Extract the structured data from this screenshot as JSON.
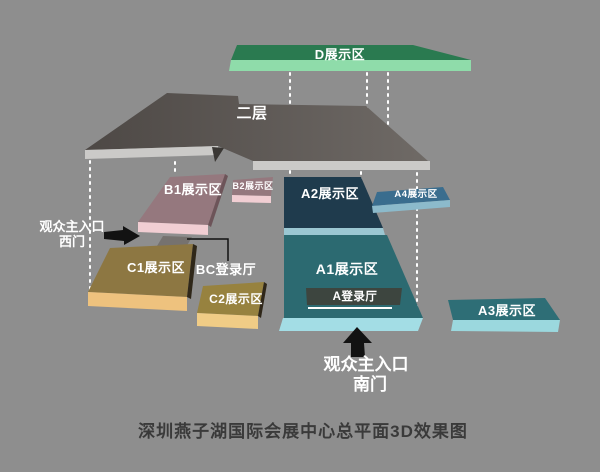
{
  "caption": "深圳燕子湖国际会展中心总平面3D效果图",
  "zones": {
    "d": {
      "label": "D展示区"
    },
    "floor2": {
      "label": "二层"
    },
    "b1": {
      "label": "B1展示区"
    },
    "b2": {
      "label": "B2展示区"
    },
    "c1": {
      "label": "C1展示区"
    },
    "c2": {
      "label": "C2展示区"
    },
    "a1": {
      "label": "A1展示区"
    },
    "a2": {
      "label": "A2展示区"
    },
    "a3": {
      "label": "A3展示区"
    },
    "a4": {
      "label": "A4展示区"
    },
    "a_hall": {
      "label": "A登录厅"
    },
    "bc_hall": {
      "label": "BC登录厅"
    }
  },
  "entrances": {
    "west": {
      "line1": "观众主入口",
      "line2": "西门"
    },
    "south": {
      "line1": "观众主入口",
      "line2": "南门"
    }
  },
  "colors": {
    "background": "#8e8e8e",
    "d_top": "#2a7a50",
    "d_front": "#8fdcaa",
    "floor2_top_dark": "#4d4845",
    "floor2_top_light": "#6f6a66",
    "floor2_front": "#cbcac8",
    "floor2_wedge": "#3a3734",
    "b_top": "#95787e",
    "b_side": "#6d5459",
    "b_front": "#f1ced3",
    "ramp": "#76726f",
    "c1_top": "#8d7742",
    "c2_top": "#97823f",
    "c_side": "#2f2719",
    "c1_front": "#eec27e",
    "c2_front": "#f0cc86",
    "a1_top": "#2c6a71",
    "a1_front": "#a3dde5",
    "a2_top": "#1f3b4d",
    "a2_front": "#9bc7d2",
    "a3_top": "#2e6e76",
    "a3_front": "#9bd8de",
    "a4_top": "#3a6d8e",
    "a4_front": "#8cbacb",
    "hall_bar": "#3d453f",
    "arrow": "#121212",
    "leader": "#111111",
    "dotted": "#ffffff",
    "label_text": "#ffffff",
    "caption_text": "#3a3a3a"
  }
}
